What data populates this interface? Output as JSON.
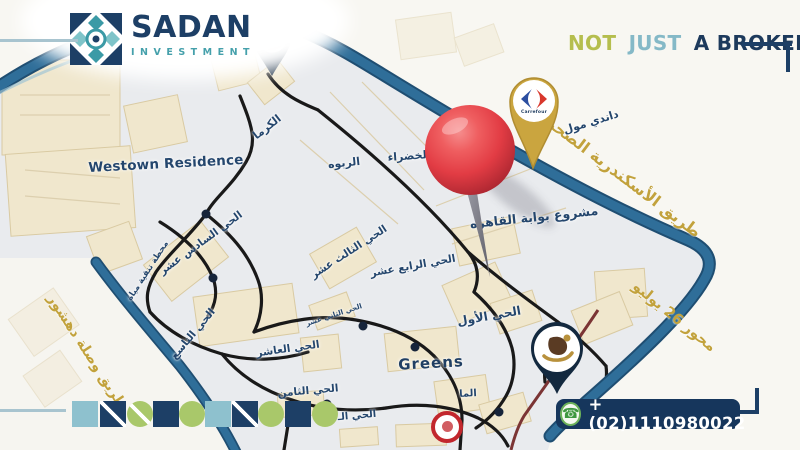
{
  "header": {
    "logo_text": "SADAN",
    "logo_subtext": "INVESTMENT",
    "tagline": {
      "not": "NOT",
      "just": "JUST",
      "a_broker": "A BROKER"
    }
  },
  "footer": {
    "phone": "+(02)1110980022"
  },
  "map": {
    "road_labels": {
      "alex_desert": "طريق الأسكندرية الصحراوي",
      "july26": "محور 26 يوليو",
      "dahshur": "طريق وصلة دهشور"
    },
    "pins": {
      "al_ahly": "النادي الأهلي",
      "dandy_mall": "داندي مول",
      "carrefour_word": "Carrefour"
    },
    "labels": {
      "westown": "Westown Residence",
      "karma": "الكرما",
      "rabwa": "الربوه",
      "khadraa": "الخضراء",
      "cairo_gate": "مشروع بوابة القاهره",
      "d13": "الحي الثالث عشر",
      "d14": "الحي الرابع عشر",
      "d16": "الحي السادس عشر",
      "water": "محطة تنقية مياة",
      "d9": "الحي التاسع",
      "d10": "الحي العاشر",
      "d8": "الحي الثامن",
      "d12": "الحي الثاني عشر",
      "d1": "الحي الأول",
      "greens": "Greens",
      "elma": "الما",
      "d_partial": "الحي الـ"
    },
    "colors": {
      "navy": "#1d3f66",
      "teal": "#45a0ab",
      "olive": "#b5be4e",
      "light_blue": "#8ec1ce",
      "green": "#a9c86a",
      "gold": "#c2a23c",
      "road_blue": "#2f6e99",
      "pin_red": "#e23c44",
      "map_bg": "#e9ebee"
    }
  }
}
